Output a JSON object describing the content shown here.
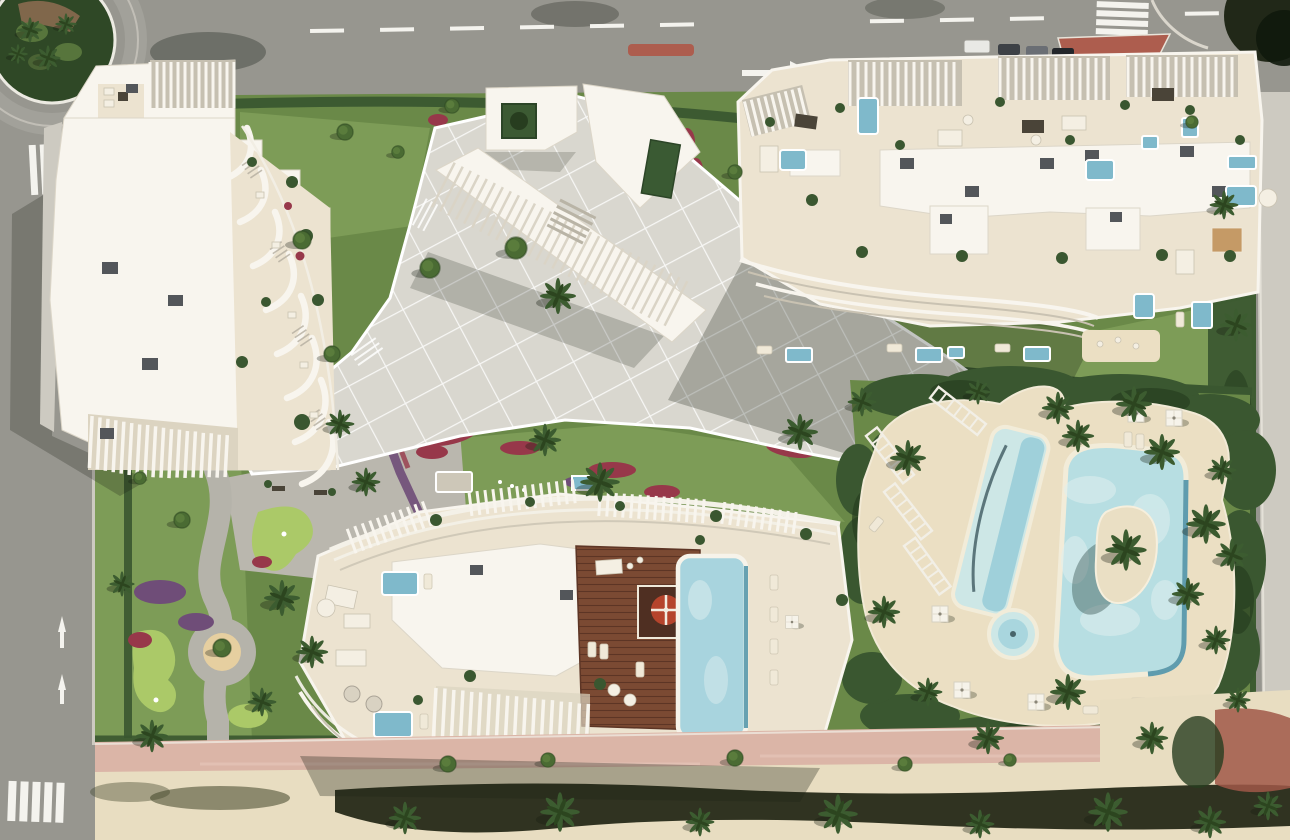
{
  "meta": {
    "kind": "aerial-architectural-render",
    "description": "Top-down 3D render of a beachfront residential resort masterplan with three white apartment buildings, rooftop terraces, lagoon pool complex, gardens and surrounding streets",
    "canvas": {
      "width": 1290,
      "height": 840
    },
    "visible_text": "none"
  },
  "palette": {
    "asphalt": "#97968f",
    "asphaltLight": "#a8a7a0",
    "sidewalk": "#cdcac1",
    "roadMark": "#f4f3ee",
    "lawn": "#6a8948",
    "lawnLight": "#7d9c57",
    "hedge": "#3a5730",
    "hedgeDark": "#273d1f",
    "paving": "#d9d7cf",
    "roofWhite": "#f8f5ee",
    "terrace": "#ece3d0",
    "terraceShade": "#dcd4c1",
    "slatBase": "#c6c0b1",
    "acUnit": "#53565a",
    "poolBlue": "#7fb9cb",
    "poolLight": "#cde7e6",
    "poolLagoon": "#b7dee2",
    "poolDeep": "#4f93a8",
    "sandDeck": "#ebdfc3",
    "deckWood": "#7b4a33",
    "deckWoodDark": "#5d3525",
    "flowersRed": "#97384a",
    "flowersPurple": "#6f4d78",
    "puttingGreen": "#abc968",
    "promPink": "#dbb5a7",
    "promSand": "#e8ddc1",
    "shadowCol": "#141b10",
    "islandSand": "#eadfc4",
    "redStructure": "#a05848",
    "palmGreen": "#3c5c30",
    "palmDark": "#2c451f",
    "treeGreen": "#4a6b33"
  },
  "scene": {
    "roads": [
      "top-boulevard-with-dashed-lane-markings-and-right-arrow",
      "left-avenue-with-zebra-crossings-and-lane-arrows",
      "roundabout-with-tropical-planting",
      "top-right-side-street-with-zebra-crossing-red-median-and-parked-cars",
      "east-service-road"
    ],
    "buildings": [
      {
        "name": "west-building",
        "features": [
          "white-flat-roof",
          "curved-balcony-fins",
          "slatted-pergolas",
          "rooftop-furniture",
          "ac-units"
        ]
      },
      {
        "name": "northeast-building",
        "features": [
          "rooftop-terraces",
          "slatted-pergolas",
          "plunge-pools",
          "central-core",
          "wavy-balconies",
          "ground-floor-garden-pools"
        ]
      },
      {
        "name": "south-building",
        "features": [
          "rooftop-timber-deck",
          "rooftop-lap-pool",
          "red-parasol-kiosk",
          "pergola-arcs",
          "slat-fences",
          "plunge-pools",
          "wavy-balconies"
        ]
      }
    ],
    "amenities": [
      "lagoon-pool-with-palm-island",
      "angled-lap-pool",
      "round-spa-pool",
      "sand-sun-deck-with-parasols-and-loungers",
      "white-trellis-frames",
      "central-paved-plaza-with-grid-joints",
      "gravel-forecourt-with-benches",
      "putting-greens",
      "sand-playground-circle",
      "entrance-pavilions-with-planter-courtyard"
    ],
    "landscape": [
      "perimeter-hedges",
      "palm-trees-with-cast-shadows",
      "round-canopy-trees",
      "red-and-purple-flower-beds",
      "lavender-lined-paths",
      "pink-beach-promenade",
      "sand-beach-strip-with-palm-row",
      "long-building-shadows-toward-southwest"
    ]
  }
}
